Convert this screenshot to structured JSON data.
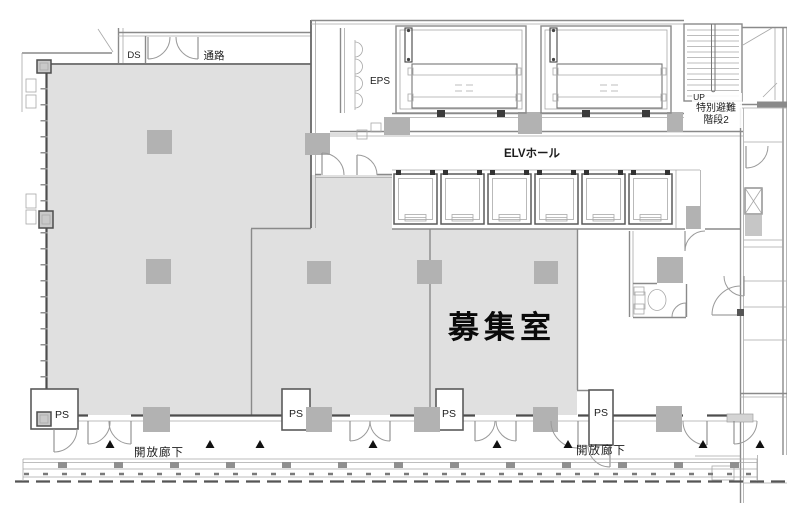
{
  "drawing": {
    "type": "architectural-floor-plan",
    "colors": {
      "background": "#ffffff",
      "room_fill": "#e0e0e0",
      "column_fill": "#b2b2b2",
      "wall_dark": "#4d4d4d",
      "wall_medium": "#8a8a8a",
      "wall_light": "#a8a8a8",
      "text": "#1c1c1c",
      "marker": "#111111"
    },
    "labels": {
      "duct_shaft": "DS",
      "passage": "通路",
      "electrical_shaft": "EPS",
      "elevator_hall": "ELVホール",
      "stair_up": "UP",
      "stair_name_line1": "特別避難",
      "stair_name_line2": "階段2",
      "vacant_room": "募集室",
      "pipe_shaft_1": "PS",
      "pipe_shaft_2": "PS",
      "pipe_shaft_3": "PS",
      "pipe_shaft_4": "PS",
      "open_corridor_left": "開放廊下",
      "open_corridor_right": "開放廊下"
    }
  }
}
